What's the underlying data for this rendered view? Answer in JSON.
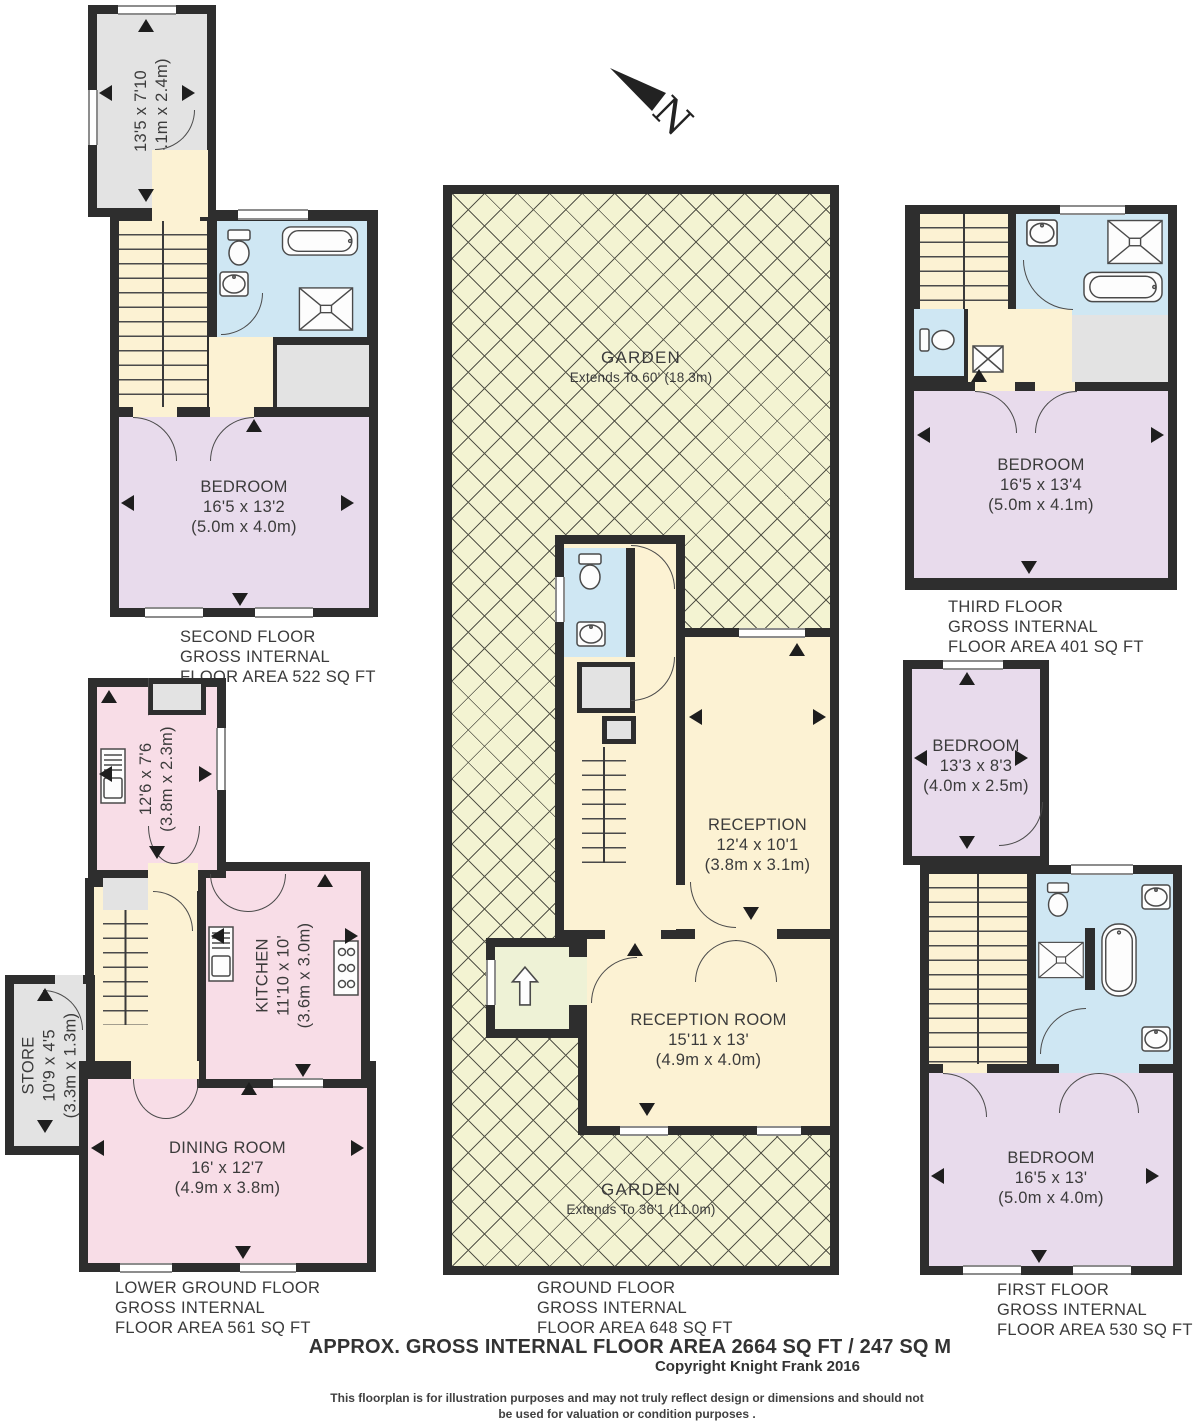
{
  "colors": {
    "wall": "#2e2e2e",
    "bedroom": "#e8dbec",
    "hall": "#fcf2d3",
    "bathroom": "#cfe7f3",
    "kitchen": "#f8dde7",
    "store": "#e3e3e3",
    "garden": "#f3f3d2",
    "porch": "#eef2d6",
    "outline": "#4a4a4a",
    "text": "#3b3b3b"
  },
  "north": {
    "label": "N"
  },
  "floors": {
    "second": {
      "terrace": {
        "dims": "13'5 x 7'10",
        "metric": "(4.1m x 2.4m)"
      },
      "bedroom": {
        "name": "BEDROOM",
        "dims": "16'5 x 13'2",
        "metric": "(5.0m x 4.0m)"
      },
      "label": [
        "SECOND FLOOR",
        "GROSS INTERNAL",
        "FLOOR AREA 522 SQ FT"
      ]
    },
    "third": {
      "bedroom": {
        "name": "BEDROOM",
        "dims": "16'5 x 13'4",
        "metric": "(5.0m x 4.1m)"
      },
      "label": [
        "THIRD FLOOR",
        "GROSS INTERNAL",
        "FLOOR AREA 401 SQ FT"
      ]
    },
    "ground": {
      "garden_top": {
        "name": "GARDEN",
        "extends": "Extends To 60' (18.3m)"
      },
      "garden_bottom": {
        "name": "GARDEN",
        "extends": "Extends To 36'1 (11.0m)"
      },
      "reception": {
        "name": "RECEPTION",
        "dims": "12'4 x 10'1",
        "metric": "(3.8m x 3.1m)"
      },
      "reception_room": {
        "name": "RECEPTION ROOM",
        "dims": "15'11 x 13'",
        "metric": "(4.9m x 4.0m)"
      },
      "label": [
        "GROUND FLOOR",
        "GROSS INTERNAL",
        "FLOOR AREA 648 SQ FT"
      ]
    },
    "lower": {
      "utility": {
        "dims": "12'6 x 7'6",
        "metric": "(3.8m x 2.3m)"
      },
      "kitchen": {
        "name": "KITCHEN",
        "dims": "11'10 x 10'",
        "metric": "(3.6m x 3.0m)"
      },
      "store": {
        "name": "STORE",
        "dims": "10'9 x 4'5",
        "metric": "(3.3m x 1.3m)"
      },
      "dining": {
        "name": "DINING ROOM",
        "dims": "16' x 12'7",
        "metric": "(4.9m x 3.8m)"
      },
      "label": [
        "LOWER GROUND FLOOR",
        "GROSS INTERNAL",
        "FLOOR AREA 561 SQ FT"
      ]
    },
    "first": {
      "bedroom_small": {
        "name": "BEDROOM",
        "dims": "13'3 x 8'3",
        "metric": "(4.0m x 2.5m)"
      },
      "bedroom_large": {
        "name": "BEDROOM",
        "dims": "16'5 x 13'",
        "metric": "(5.0m x 4.0m)"
      },
      "label": [
        "FIRST FLOOR",
        "GROSS INTERNAL",
        "FLOOR AREA 530 SQ FT"
      ]
    }
  },
  "footer": {
    "approx": "APPROX. GROSS INTERNAL FLOOR AREA 2664 SQ FT / 247 SQ M",
    "copyright": "Copyright Knight Frank 2016",
    "disclaimer1": "This floorplan is for illustration purposes and may not truly reflect design or dimensions and should not",
    "disclaimer2": "be used for valuation or condition purposes ."
  }
}
